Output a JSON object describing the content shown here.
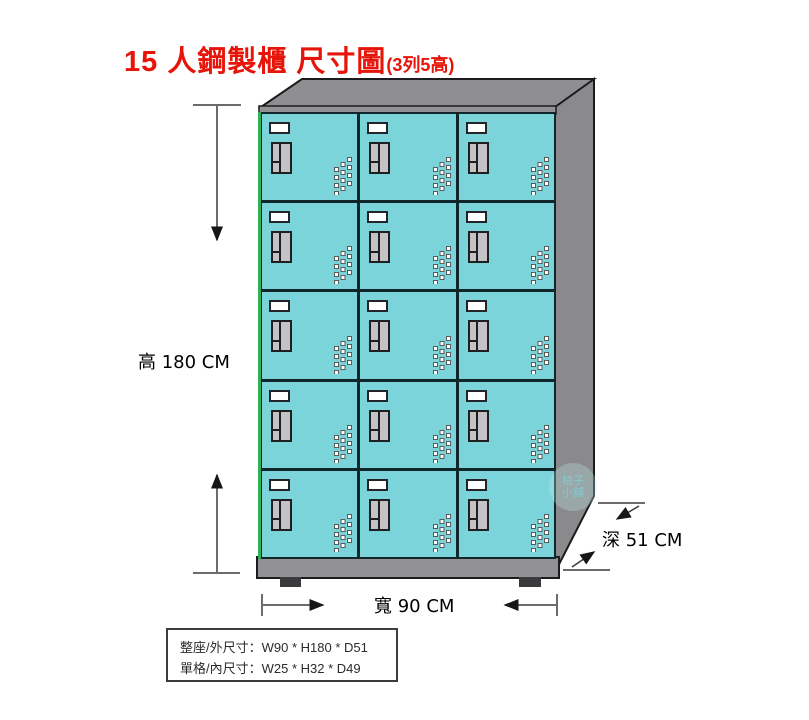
{
  "title": {
    "main": "15 人鋼製櫃 尺寸圖",
    "suffix": "(3列5高)"
  },
  "cabinet": {
    "rows": 5,
    "cols": 3,
    "door_count": 15
  },
  "dimensions": {
    "height_label": "高 180 CM",
    "width_label": "寬 90 CM",
    "depth_label": "深 51 CM"
  },
  "spec_box": {
    "line1": "整座/外尺寸：W90 * H180 * D51",
    "line2": "單格/內尺寸：W25 * H32 * D49"
  },
  "watermark": {
    "line1": "柚子",
    "line2": "小舖"
  },
  "colors": {
    "title_red": "#e71409",
    "door_teal": "#7bd4da",
    "cabinet_top_gray": "#8f8f91",
    "cabinet_side_gray": "#8a8a8c",
    "base_gray": "#929294",
    "feet_dark": "#3a3a3c",
    "frame_green": "#2fb157",
    "outline_dark": "#1c1c1e"
  }
}
